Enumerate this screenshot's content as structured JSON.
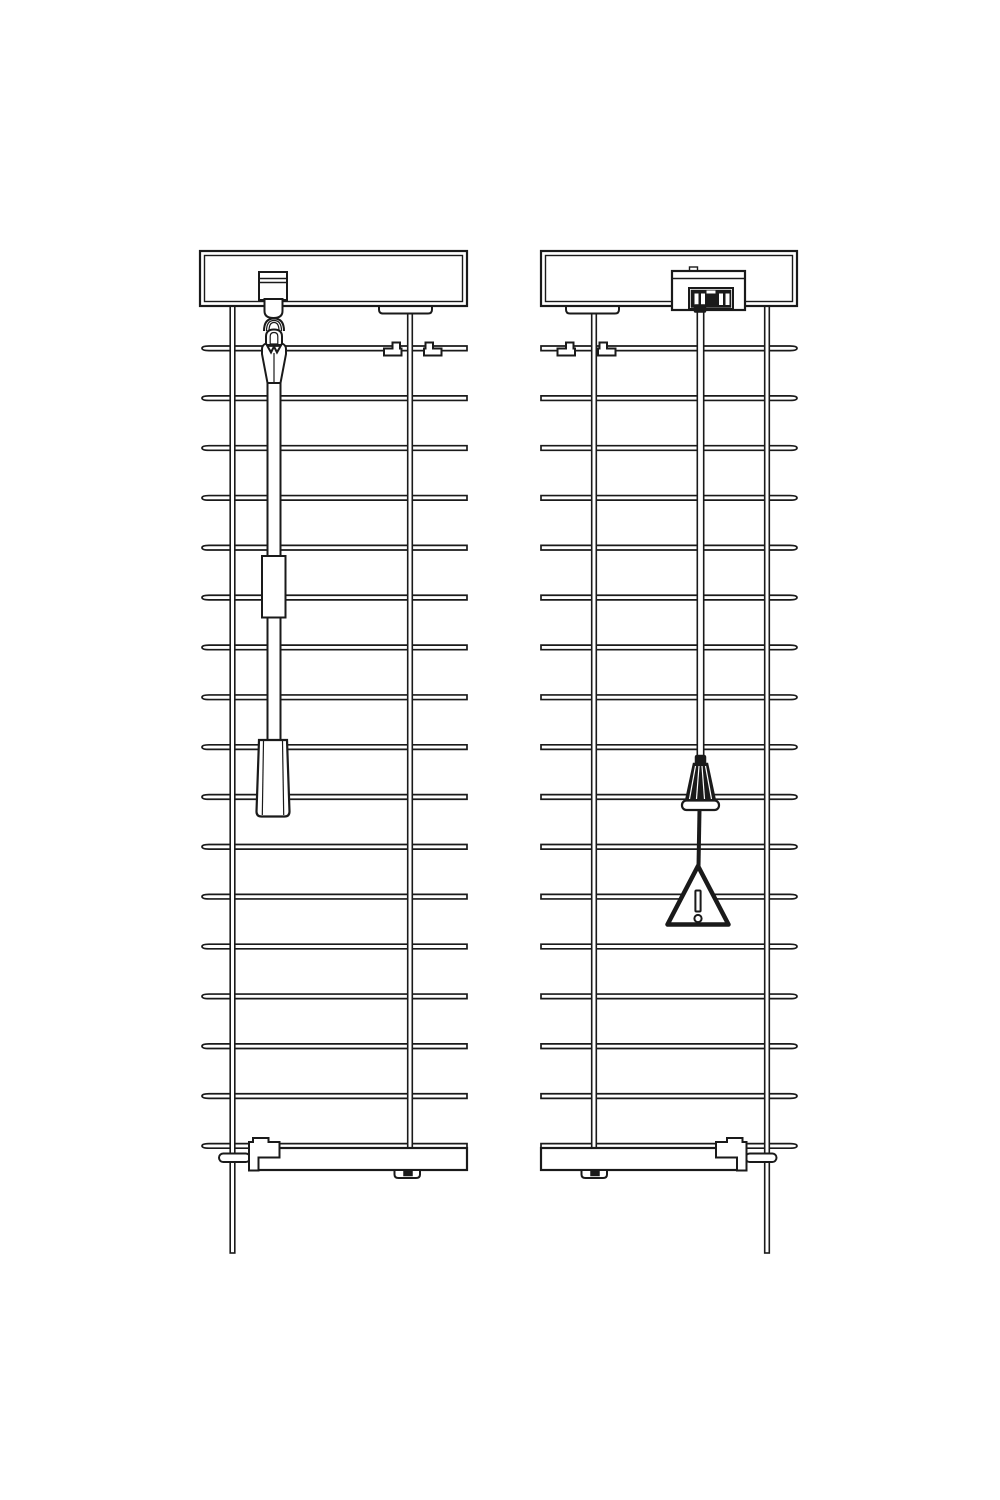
{
  "canvas": {
    "width": 1000,
    "height": 1500,
    "background": "#ffffff",
    "line_color": "#1a1a1a"
  },
  "diagram": {
    "type": "technical-line-drawing",
    "subject": "horizontal-venetian-blinds-front-views",
    "panels": [
      {
        "label": "blind-with-tilt-wand",
        "slats": {
          "count": 17,
          "left_x": 202,
          "right_x": 467,
          "first_y": 346,
          "spacing": 49.85,
          "thickness": 4.6,
          "curl_side": "left"
        },
        "ladders": [
          {
            "center_x": 232.5,
            "top_y": 306,
            "bottom_y": 1253,
            "width": 4.6
          },
          {
            "center_x": 410,
            "top_y": 311,
            "bottom_y": 1150,
            "width": 4.6
          }
        ]
      },
      {
        "label": "blind-with-lift-cord-and-safety-tassel",
        "slats": {
          "count": 17,
          "left_x": 541,
          "right_x": 797,
          "first_y": 346,
          "spacing": 49.85,
          "thickness": 4.6,
          "curl_side": "right"
        },
        "ladders": [
          {
            "center_x": 594,
            "top_y": 311,
            "bottom_y": 1150,
            "width": 4.6
          },
          {
            "center_x": 767,
            "top_y": 306,
            "bottom_y": 1253,
            "width": 4.6
          }
        ]
      }
    ]
  }
}
